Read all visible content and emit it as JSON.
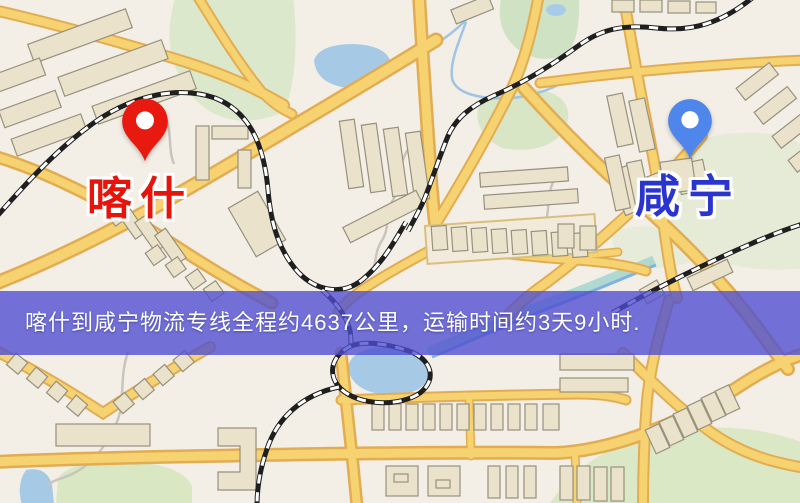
{
  "map": {
    "markers": [
      {
        "name": "kashgar",
        "label": "喀什",
        "label_color": "#e6150c",
        "pin_color": "#e8190f"
      },
      {
        "name": "xianning",
        "label": "咸宁",
        "label_color": "#2a35cf",
        "pin_color": "#4f86ec"
      }
    ],
    "banner": {
      "text": "喀什到咸宁物流专线全程约4637公里，运输时间约3天9小时.",
      "background": "rgba(77,77,209,0.78)",
      "text_color": "#ffffff"
    },
    "route": {
      "origin": "喀什",
      "destination": "咸宁",
      "distance": "约4637公里",
      "duration": "约3天9小时"
    }
  }
}
